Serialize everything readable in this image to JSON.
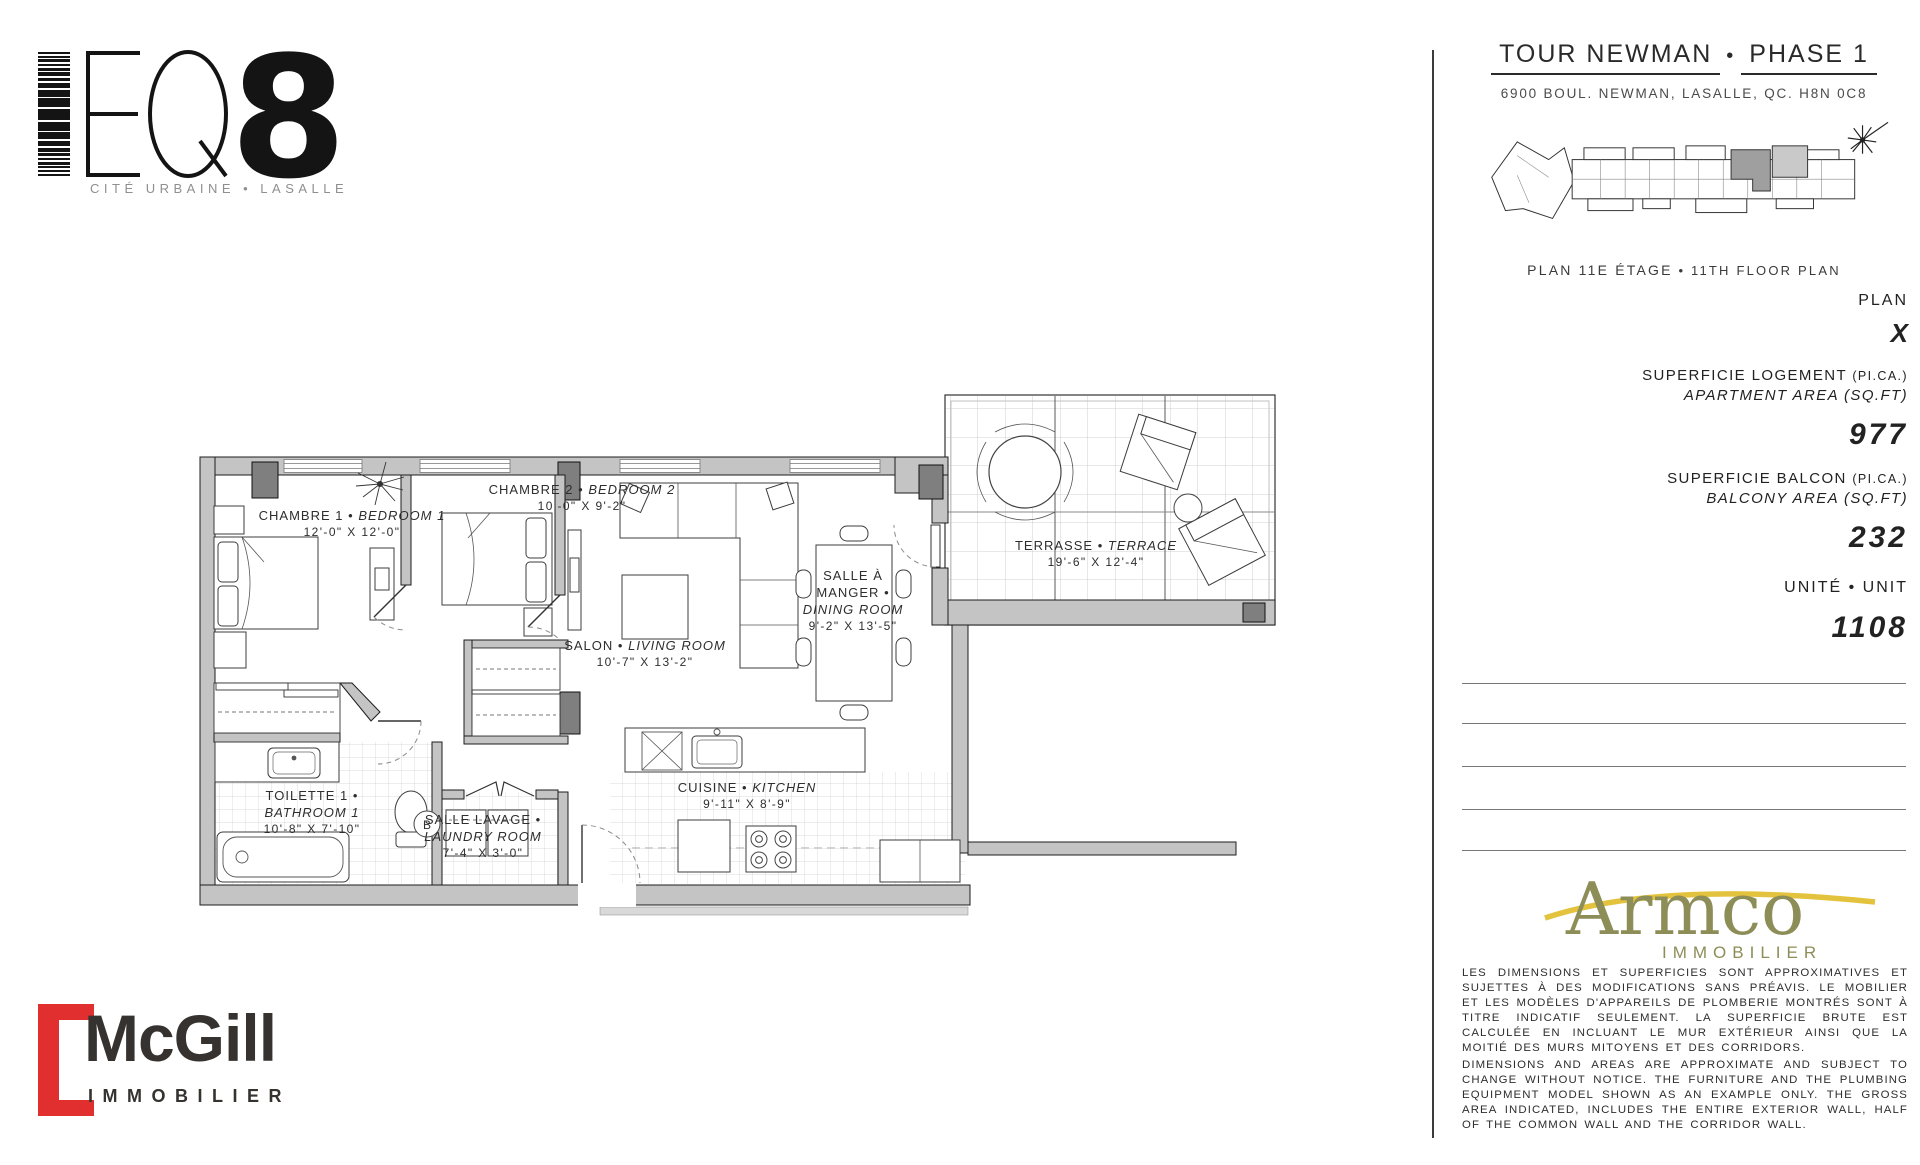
{
  "brand": {
    "name": "EQ8",
    "tagline": "CITÉ URBAINE • LASALLE"
  },
  "header": {
    "title_fr": "TOUR NEWMAN",
    "bullet": "•",
    "title_en": "PHASE 1",
    "address": "6900 BOUL. NEWMAN, LASALLE, QC. H8N 0C8"
  },
  "keyplan": {
    "caption_fr": "PLAN 11E ÉTAGE",
    "bullet": "•",
    "caption_en": "11TH FLOOR PLAN",
    "highlight_color": "#9f9f9f"
  },
  "specs": {
    "plan_label": "PLAN",
    "plan_value": "X",
    "apartment_area_label_fr": "SUPERFICIE LOGEMENT",
    "apartment_area_unit_fr": "(PI.CA.)",
    "apartment_area_label_en": "APARTMENT AREA",
    "apartment_area_unit_en": "(SQ.FT)",
    "apartment_area_value": "977",
    "balcony_area_label_fr": "SUPERFICIE BALCON",
    "balcony_area_unit_fr": "(PI.CA.)",
    "balcony_area_label_en": "BALCONY AREA",
    "balcony_area_unit_en": "(SQ.FT)",
    "balcony_area_value": "232",
    "unit_label": "UNITÉ • UNIT",
    "unit_value": "1108"
  },
  "plan": {
    "bullet": "•",
    "door_label": "B",
    "rooms": [
      {
        "fr": "CHAMBRE 1",
        "en": "BEDROOM 1",
        "dims": "12'-0\" X 12'-0\""
      },
      {
        "fr": "CHAMBRE 2",
        "en": "BEDROOM 2",
        "dims": "10'-0\" X 9'-2\""
      },
      {
        "fr": "SALON",
        "en": "LIVING ROOM",
        "dims": "10'-7\" X 13'-2\""
      },
      {
        "fr": "SALLE À MANGER",
        "en": "DINING ROOM",
        "dims": "9'-2\" X 13'-5\""
      },
      {
        "fr": "TERRASSE",
        "en": "TERRACE",
        "dims": "19'-6\" X 12'-4\""
      },
      {
        "fr": "TOILETTE 1",
        "en": "BATHROOM 1",
        "dims": "10'-8\" X 7'-10\""
      },
      {
        "fr": "SALLE LAVAGE",
        "en": "LAUNDRY ROOM",
        "dims": "7'-4\" X 3'-0\""
      },
      {
        "fr": "CUISINE",
        "en": "KITCHEN",
        "dims": "9'-11\" X 8'-9\""
      }
    ]
  },
  "developer": {
    "name": "Armco",
    "subtitle": "IMMOBILIER",
    "olive": "#8d8d58",
    "gold": "#e3c33d"
  },
  "broker": {
    "name": "McGill",
    "subtitle": "IMMOBILIER",
    "red": "#e12f2f"
  },
  "disclaimers": {
    "fr": "LES DIMENSIONS ET SUPERFICIES SONT APPROXIMATIVES ET SUJETTES À DES MODIFICATIONS SANS PRÉAVIS. LE MOBILIER ET LES MODÈLES D'APPAREILS DE PLOMBERIE MONTRÉS SONT À TITRE INDICATIF SEULEMENT. LA SUPERFICIE BRUTE EST CALCULÉE EN INCLUANT LE MUR EXTÉRIEUR AINSI QUE LA MOITIÉ DES MURS MITOYENS ET DES CORRIDORS.",
    "en": "DIMENSIONS AND AREAS ARE APPROXIMATE AND SUBJECT TO CHANGE WITHOUT NOTICE. THE FURNITURE AND THE PLUMBING EQUIPMENT MODEL SHOWN AS AN EXAMPLE ONLY. THE GROSS AREA INDICATED, INCLUDES THE ENTIRE EXTERIOR WALL, HALF OF THE COMMON WALL AND THE CORRIDOR WALL."
  }
}
